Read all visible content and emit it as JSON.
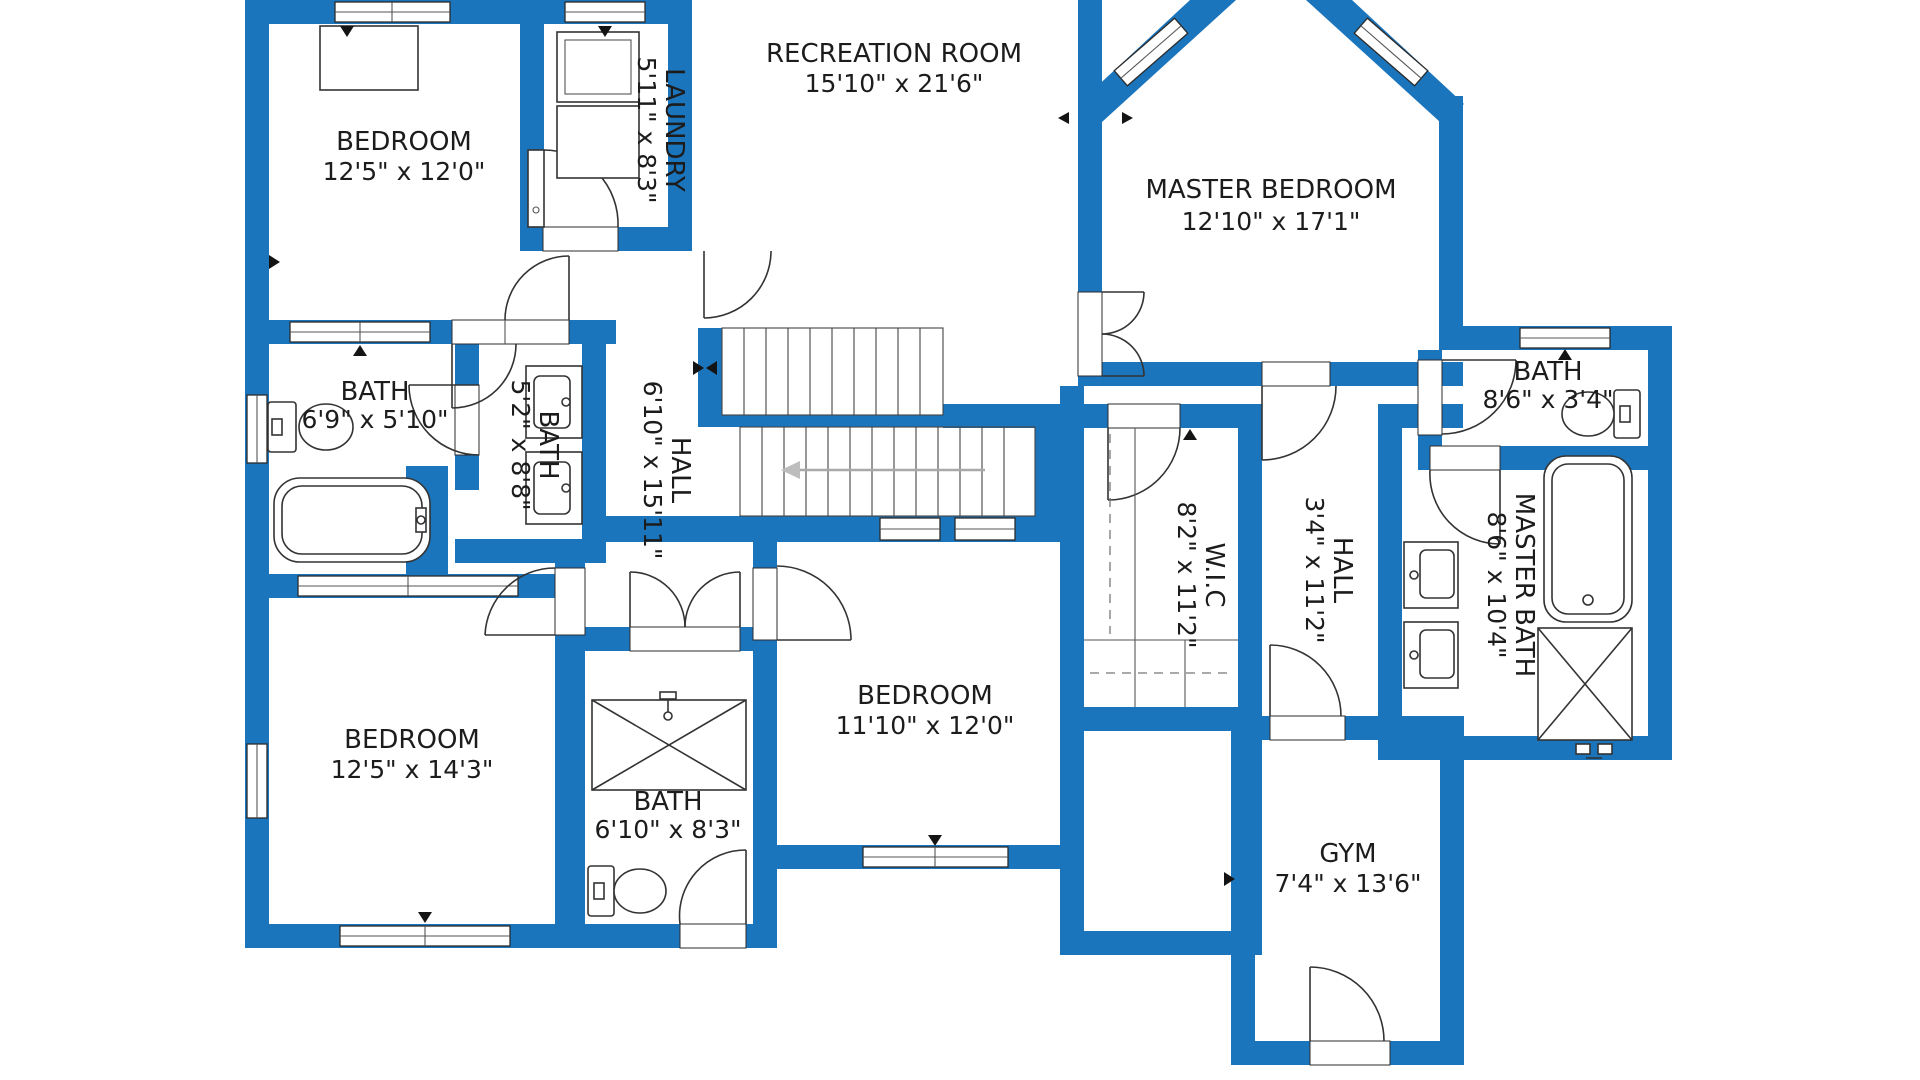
{
  "colors": {
    "wall_blue": "#1b75bc",
    "line_dark": "#333333",
    "background": "#ffffff",
    "stair_arrow_gray": "#bdbdbd"
  },
  "rooms": {
    "bedroom_tl": {
      "label": "BEDROOM",
      "dims": "12'5\" x 12'0\""
    },
    "laundry": {
      "label": "LAUNDRY",
      "dims": "5'11\" x 8'3\""
    },
    "recreation": {
      "label": "RECREATION ROOM",
      "dims": "15'10\" x 21'6\""
    },
    "master_bedroom": {
      "label": "MASTER BEDROOM",
      "dims": "12'10\" x 17'1\""
    },
    "bath_right": {
      "label": "BATH",
      "dims": "8'6\" x 3'4\""
    },
    "bath_left": {
      "label": "BATH",
      "dims": "6'9\" x 5'10\""
    },
    "bath_center": {
      "label": "BATH",
      "dims": "5'2\" x 8'8\""
    },
    "hall_main": {
      "label": "HALL",
      "dims": "6'10\" x 15'11\""
    },
    "wic": {
      "label": "W.I.C",
      "dims": "8'2\" x 11'2\""
    },
    "hall_upper": {
      "label": "HALL",
      "dims": "3'4\" x 11'2\""
    },
    "master_bath": {
      "label": "MASTER BATH",
      "dims": "8'6\" x 10'4\""
    },
    "bedroom_bl": {
      "label": "BEDROOM",
      "dims": "12'5\" x 14'3\""
    },
    "bath_bottom": {
      "label": "BATH",
      "dims": "6'10\" x 8'3\""
    },
    "bedroom_bc": {
      "label": "BEDROOM",
      "dims": "11'10\" x 12'0\""
    },
    "gym": {
      "label": "GYM",
      "dims": "7'4\" x 13'6\""
    }
  }
}
